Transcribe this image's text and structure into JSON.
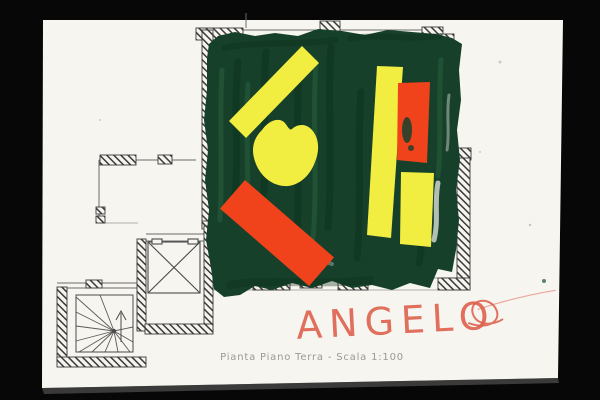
{
  "photo": {
    "background_color": "#070707",
    "paper_color": "#f7f5ef"
  },
  "artwork": {
    "title_caption": "Pianta Piano Terra - Scala 1:100",
    "signature": "ANGELO",
    "colors": {
      "paint_green": "#16402a",
      "paint_green_dark": "#0b2f1b",
      "paint_green_light": "#2d6642",
      "paint_yellow": "#f2ee41",
      "paint_orange": "#f1431b",
      "signature_red": "#dd5c49",
      "caption_gray": "#8e8d89",
      "plan_line": "#3a3a3a"
    },
    "plan": {
      "depicts": [
        "floor-plan",
        "hatched-walls",
        "elevator-shaft",
        "spiral-staircase",
        "scale-caption"
      ]
    }
  }
}
